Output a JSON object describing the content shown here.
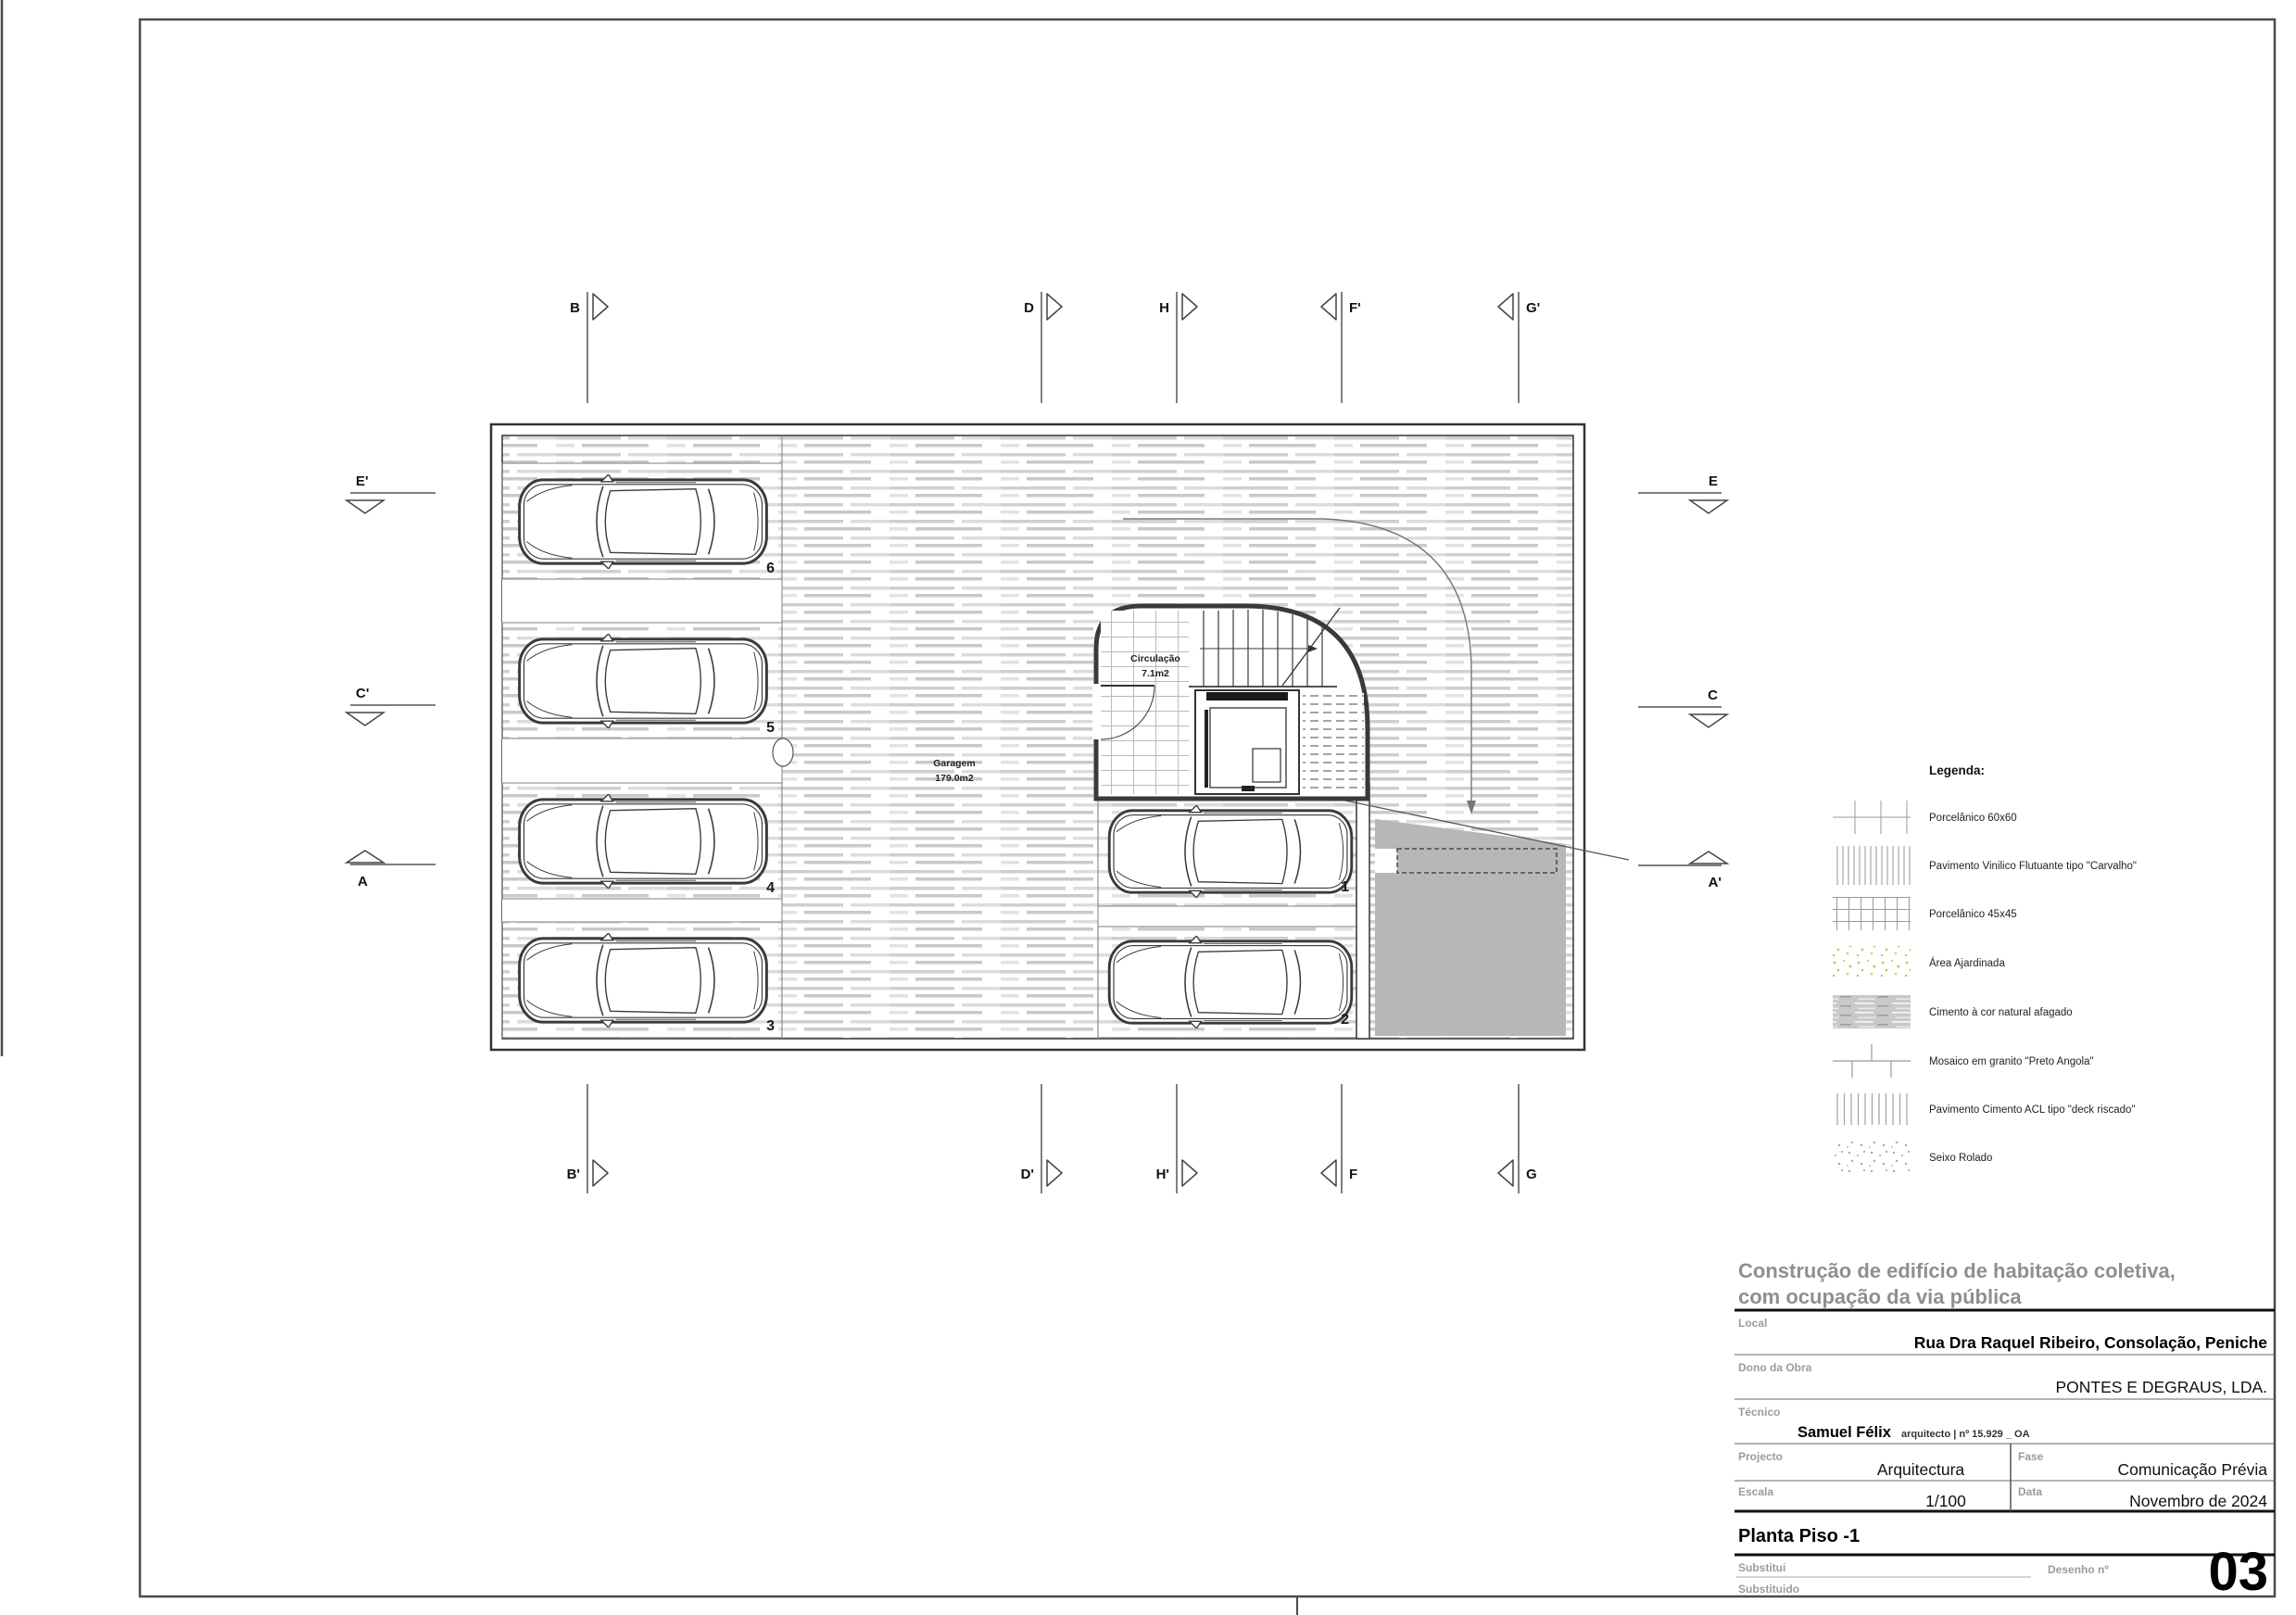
{
  "plan": {
    "rooms": {
      "garagem": {
        "name": "Garagem",
        "area": "179.0m2"
      },
      "circulacao": {
        "name": "Circulação",
        "area": "7.1m2"
      }
    },
    "parking_spaces": [
      {
        "number": "6"
      },
      {
        "number": "5"
      },
      {
        "number": "4"
      },
      {
        "number": "3"
      },
      {
        "number": "1"
      },
      {
        "number": "2"
      }
    ],
    "markers": {
      "top": [
        {
          "label": "B"
        },
        {
          "label": "D"
        },
        {
          "label": "H"
        },
        {
          "label": "F'"
        },
        {
          "label": "G'"
        }
      ],
      "bottom": [
        {
          "label": "B'"
        },
        {
          "label": "D'"
        },
        {
          "label": "H'"
        },
        {
          "label": "F"
        },
        {
          "label": "G"
        }
      ],
      "left": [
        {
          "label": "E'"
        },
        {
          "label": "C'"
        },
        {
          "label": "A"
        }
      ],
      "right": [
        {
          "label": "E"
        },
        {
          "label": "C"
        },
        {
          "label": "A'"
        }
      ]
    }
  },
  "legend": {
    "title": "Legenda:",
    "items": [
      {
        "label": "Porcelânico 60x60",
        "swatch": "grid-60"
      },
      {
        "label": "Pavimento Vinilico Flutuante tipo \"Carvalho\"",
        "swatch": "vertical-lines"
      },
      {
        "label": "Porcelânico 45x45",
        "swatch": "grid-45"
      },
      {
        "label": "Área Ajardinada",
        "swatch": "green-speckle"
      },
      {
        "label": "Cimento à cor natural afagado",
        "swatch": "cement-streaks"
      },
      {
        "label": "Mosaico em granito \"Preto Angola\"",
        "swatch": "granite-bricks"
      },
      {
        "label": "Pavimento Cimento ACL tipo \"deck riscado\"",
        "swatch": "deck-lines"
      },
      {
        "label": "Seixo Rolado",
        "swatch": "pebble-dots"
      }
    ]
  },
  "title_block": {
    "project_heading": [
      "Construção de edifício de habitação coletiva,",
      "com ocupação da via pública"
    ],
    "local": {
      "label": "Local",
      "value": "Rua Dra Raquel Ribeiro, Consolação, Peniche"
    },
    "dono": {
      "label": "Dono da Obra",
      "value": "PONTES E DEGRAUS, LDA."
    },
    "tecnico": {
      "label": "Técnico",
      "name": "Samuel Félix",
      "details": "arquitecto | nº 15.929 _ OA"
    },
    "projecto": {
      "label": "Projecto",
      "value": "Arquitectura"
    },
    "fase": {
      "label": "Fase",
      "value": "Comunicação Prévia"
    },
    "escala": {
      "label": "Escala",
      "value": "1/100"
    },
    "data": {
      "label": "Data",
      "value": "Novembro de 2024"
    },
    "sheet_title": "Planta Piso -1",
    "substitui": {
      "label": "Substitui"
    },
    "substituido": {
      "label": "Substituido"
    },
    "desenho": {
      "label": "Desenho nº",
      "value": "03"
    }
  },
  "colors": {
    "ramp_gray": "#b7b7b7",
    "floor_streak_gray": "#cccccc",
    "heading_gray": "#8f8f8f",
    "garden_green": "#b9c94f"
  }
}
